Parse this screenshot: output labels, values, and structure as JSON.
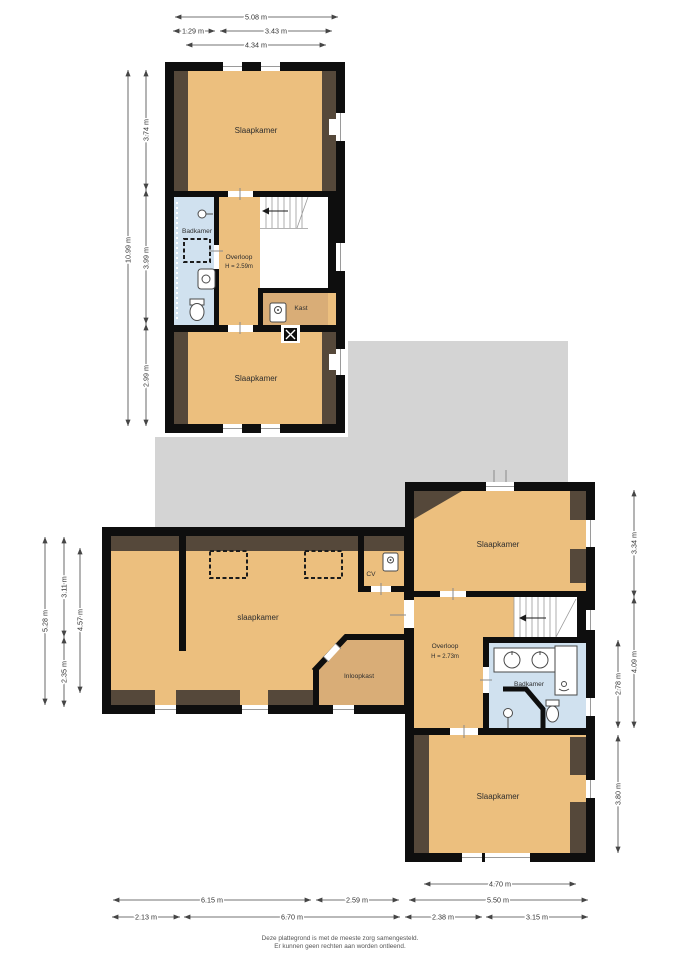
{
  "colors": {
    "wall": "#0e0e0e",
    "tan": "#ecbf7e",
    "tan_dark": "#d9ad77",
    "brown": "#55483a",
    "blue": "#d0e1ef",
    "gray": "#d4d4d4"
  },
  "top_floor": {
    "bedroom_top": "Slaapkamer",
    "bathroom": "Badkamer",
    "landing": "Overloop",
    "landing_height": "H = 2.59m",
    "closet": "Kast",
    "bedroom_bottom": "Slaapkamer"
  },
  "first_floor": {
    "bedroom_left": "slaapkamer",
    "cv": "CV",
    "walk_in_closet": "Inloopkast",
    "bedroom_ne": "Slaapkamer",
    "landing": "Overloop",
    "landing_height": "H = 2.73m",
    "bathroom": "Badkamer",
    "bedroom_se": "Slaapkamer"
  },
  "dims": {
    "top": {
      "total_w": "5.08 m",
      "w1": "1.29 m",
      "w2": "3.43 m",
      "w3": "4.34 m",
      "total_h": "10.99 m",
      "h1": "3.74 m",
      "h2": "3.99 m",
      "h3": "2.99 m"
    },
    "lower": {
      "left_total": "5.28 m",
      "left_a": "3.11 m",
      "left_b": "2.35 m",
      "left_inner": "4.57 m",
      "right_a": "3.34 m",
      "right_b": "4.09 m",
      "right_inner_a": "2.78 m",
      "right_inner_b": "3.80 m",
      "bot_a": "4.70 m",
      "bot_b1": "6.15 m",
      "bot_b2": "2.59 m",
      "bot_b3": "5.50 m",
      "bot_c1": "2.13 m",
      "bot_c2": "6.70 m",
      "bot_c3": "2.38 m",
      "bot_c4": "3.15 m"
    }
  },
  "footer": {
    "line1": "Deze plattegrond is met de meeste zorg samengesteld.",
    "line2": "Er kunnen geen rechten aan worden ontleend."
  },
  "icons": [
    "stairs",
    "toilet-icon",
    "sink-icon",
    "shower-head-icon",
    "boiler-icon",
    "chimney-icon",
    "skylight",
    "window",
    "door-opening"
  ]
}
